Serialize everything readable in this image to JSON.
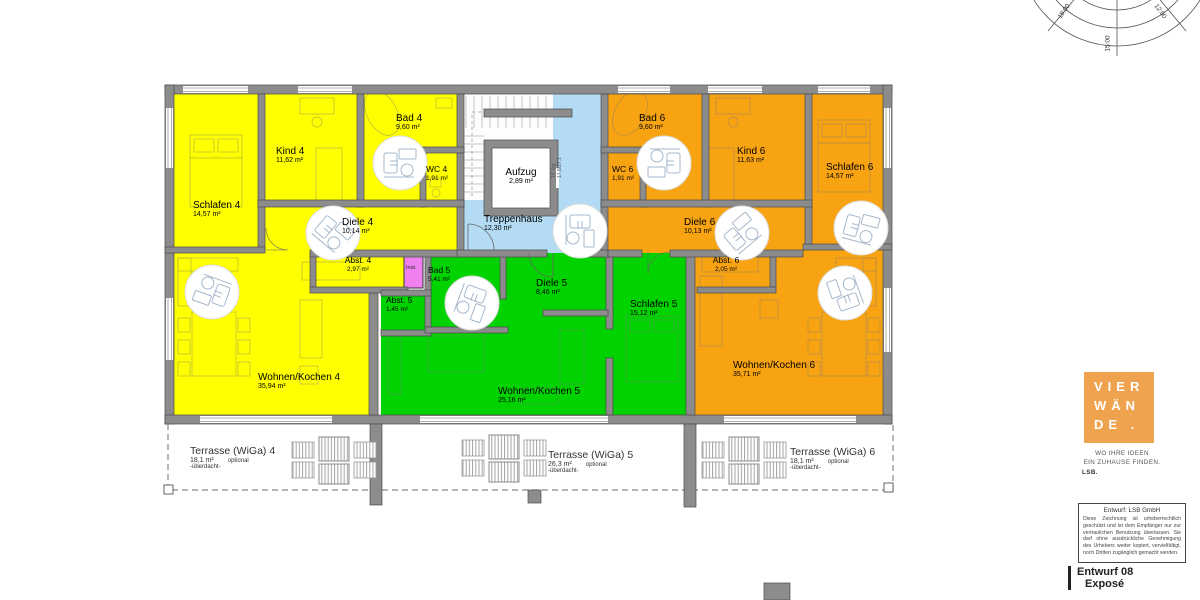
{
  "rooms": [
    {
      "name": "Schlafen 4",
      "area": "14,57 m²"
    },
    {
      "name": "Kind 4",
      "area": "11,62 m²"
    },
    {
      "name": "Bad 4",
      "area": "9,60 m²"
    },
    {
      "name": "WC 4",
      "area": "1,91 m²"
    },
    {
      "name": "Diele 4",
      "area": "10,14 m²"
    },
    {
      "name": "Abst. 4",
      "area": "2,97 m²"
    },
    {
      "name": "Wohnen/Kochen 4",
      "area": "35,94 m²"
    },
    {
      "name": "Aufzug",
      "area": "2,89 m²"
    },
    {
      "name": "Treppenhaus",
      "area": "12,30 m²"
    },
    {
      "name": "Bad 5",
      "area": "5,41 m²"
    },
    {
      "name": "Abst. 5",
      "area": "1,45 m²"
    },
    {
      "name": "Diele 5",
      "area": "8,46 m²"
    },
    {
      "name": "Schlafen 5",
      "area": "15,12 m²"
    },
    {
      "name": "Wohnen/Kochen 5",
      "area": "25,16 m²"
    },
    {
      "name": "Bad 6",
      "area": "9,60 m²"
    },
    {
      "name": "WC 6",
      "area": "1,91 m²"
    },
    {
      "name": "Kind 6",
      "area": "11,63 m²"
    },
    {
      "name": "Schlafen 6",
      "area": "14,57 m²"
    },
    {
      "name": "Diele 6",
      "area": "10,13 m²"
    },
    {
      "name": "Abst. 6",
      "area": "2,05 m²"
    },
    {
      "name": "Wohnen/Kochen 6",
      "area": "35,71 m²"
    }
  ],
  "shaft_label": "Inst.",
  "stairs": {
    "line1": "16 Stg",
    "line2": "17,8/27,1"
  },
  "terraces": [
    {
      "name": "Terrasse (WiGa) 4",
      "area": "18,1 m²",
      "option": "optional",
      "note": "-überdacht-"
    },
    {
      "name": "Terrasse (WiGa) 5",
      "area": "26,3 m²",
      "option": "optional",
      "note": "-überdacht-"
    },
    {
      "name": "Terrasse (WiGa) 6",
      "area": "18,1 m²",
      "option": "optional",
      "note": "-überdacht-"
    }
  ],
  "sun": {
    "labels": [
      "18:00",
      "15:00",
      "12:00"
    ]
  },
  "branding": {
    "logo_line1": "VIER",
    "logo_line2": "WÄN",
    "logo_line3": "DE .",
    "tagline1": "WO IHRE IDEEN",
    "tagline2": "EIN ZUHAUSE FINDEN.",
    "tagline3": "LSB."
  },
  "disclaimer": {
    "title": "Entwurf: LSB GmbH",
    "body": "Diese Zeichnung ist urheberrechtlich geschützt und ist dem Empfänger nur zur vertraulichen Benutzung überlassen. Sie darf ohne ausdrückliche Genehmigung des Urhebers weder kopiert, vervielfältigt, noch Dritten zugänglich gemacht werden."
  },
  "titleblock": {
    "line1": "Entwurf 08",
    "line2": "Exposé"
  },
  "colors": {
    "apartment4": "#FFFF00",
    "apartment5": "#00D300",
    "apartment6": "#F8A312",
    "stairwell": "#B3DCF4",
    "inst_shaft": "#F080F0",
    "walls": "#8C8C8C",
    "logo": "#EFA34F"
  }
}
